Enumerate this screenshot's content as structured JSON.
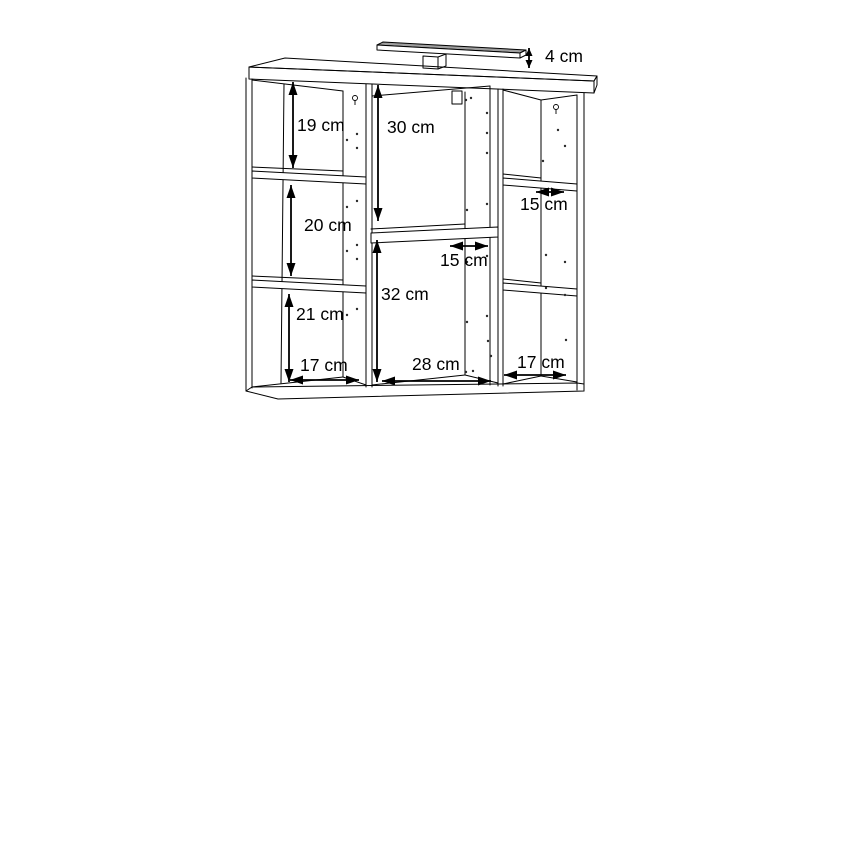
{
  "diagram": {
    "unit": "cm",
    "colors": {
      "line": "#000000",
      "background": "#ffffff",
      "lamp_shade": "#9e9e9e"
    },
    "labels": {
      "lamp_height": "4 cm",
      "left_top_height": "19 cm",
      "middle_top_height": "30 cm",
      "right_shelf_depth": "15 cm",
      "left_middle_height": "20 cm",
      "middle_shelf_depth": "15 cm",
      "middle_bottom_height": "32 cm",
      "left_bottom_height": "21 cm",
      "left_width": "17 cm",
      "middle_width": "28 cm",
      "right_width": "17 cm"
    }
  }
}
